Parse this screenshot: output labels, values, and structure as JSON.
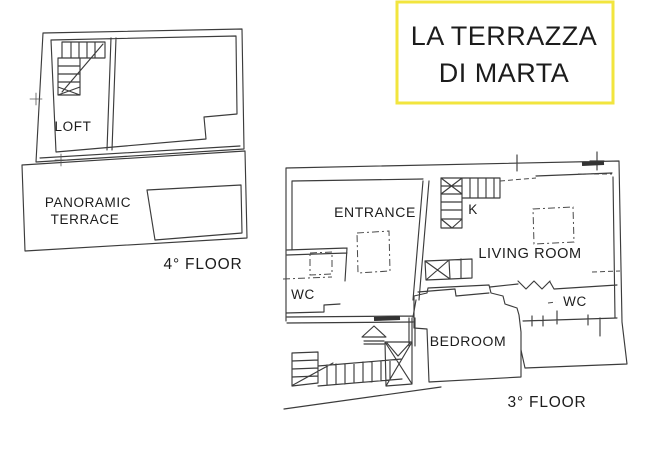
{
  "title_card": {
    "line1": "LA TERRAZZA",
    "line2": "DI MARTA",
    "border_color": "#F2E53E",
    "text_color": "#1C1C1C"
  },
  "floor4": {
    "floor_label": "4° FLOOR",
    "rooms": {
      "loft": "LOFT",
      "terrace_line1": "PANORAMIC",
      "terrace_line2": "TERRACE"
    }
  },
  "floor3": {
    "floor_label": "3° FLOOR",
    "rooms": {
      "entrance": "ENTRANCE",
      "kitchen": "K",
      "living_room": "LIVING ROOM",
      "wc_left": "WC",
      "bedroom": "BEDROOM",
      "wc_right": "WC"
    }
  },
  "drawing": {
    "line_color": "#3C3C3C",
    "background": "#FFFFFF"
  }
}
